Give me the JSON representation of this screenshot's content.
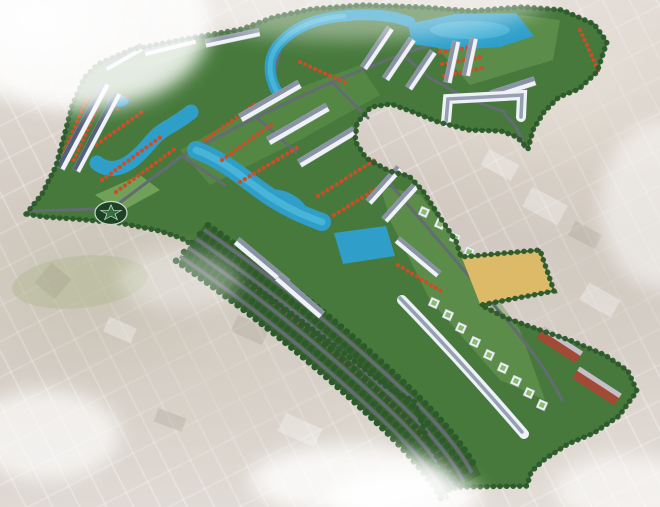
{
  "meta": {
    "image_type": "aerial 3D master-plan rendering of a residential township",
    "visible_text": "none"
  },
  "scene": {
    "setting": "faded aerial photograph of existing town with cloud wisps",
    "features": {
      "landmass": "tree-lined township footprint shaped like a broad arrow",
      "boulevard": "curved multi-lane boulevard with parallel tree rows",
      "roundabout": "roundabout with star emblem",
      "lakes": "winding landscaped lakes and canals",
      "top_lake": "large lake at the top edge with boats",
      "rect_lake": "rectangular lake beside the boulevard",
      "townhouses": "long rows of white townhouses with slate roofs",
      "villas": "rows of red-orange roofed villas",
      "apartments": "white high-rise towers with green roofs",
      "slabs": "two red-brown mid-rise blocks at lower right",
      "parcel": "vacant sandy-yellow land plot",
      "park": "flower park with small pond",
      "clouds": "white cloud wisps over the photo"
    }
  },
  "colors": {
    "background_base": "#d3cbc3",
    "tree_base": "#47793c",
    "tree_dark": "#2d5a2b",
    "lawn": "#74a558",
    "lake": "#2f9fc9",
    "lake_light": "#5cc4e4",
    "road": "#636c73",
    "boulevard_green": "#3a652f",
    "townhouse_wall": "#f0f3f6",
    "townhouse_roof": "#8a93a6",
    "townhouse_roof_blue": "#51617c",
    "villa_roof": "#c94f27",
    "tower_wall": "#ecf0f4",
    "tower_roof": "#88bb6b",
    "slab_red": "#a34a36",
    "parcel_yellow": "#ddba68",
    "star_circle": "#1c4424",
    "star": "#31703c",
    "median_pink": "#9c4f63",
    "cloud": "#ffffff"
  }
}
